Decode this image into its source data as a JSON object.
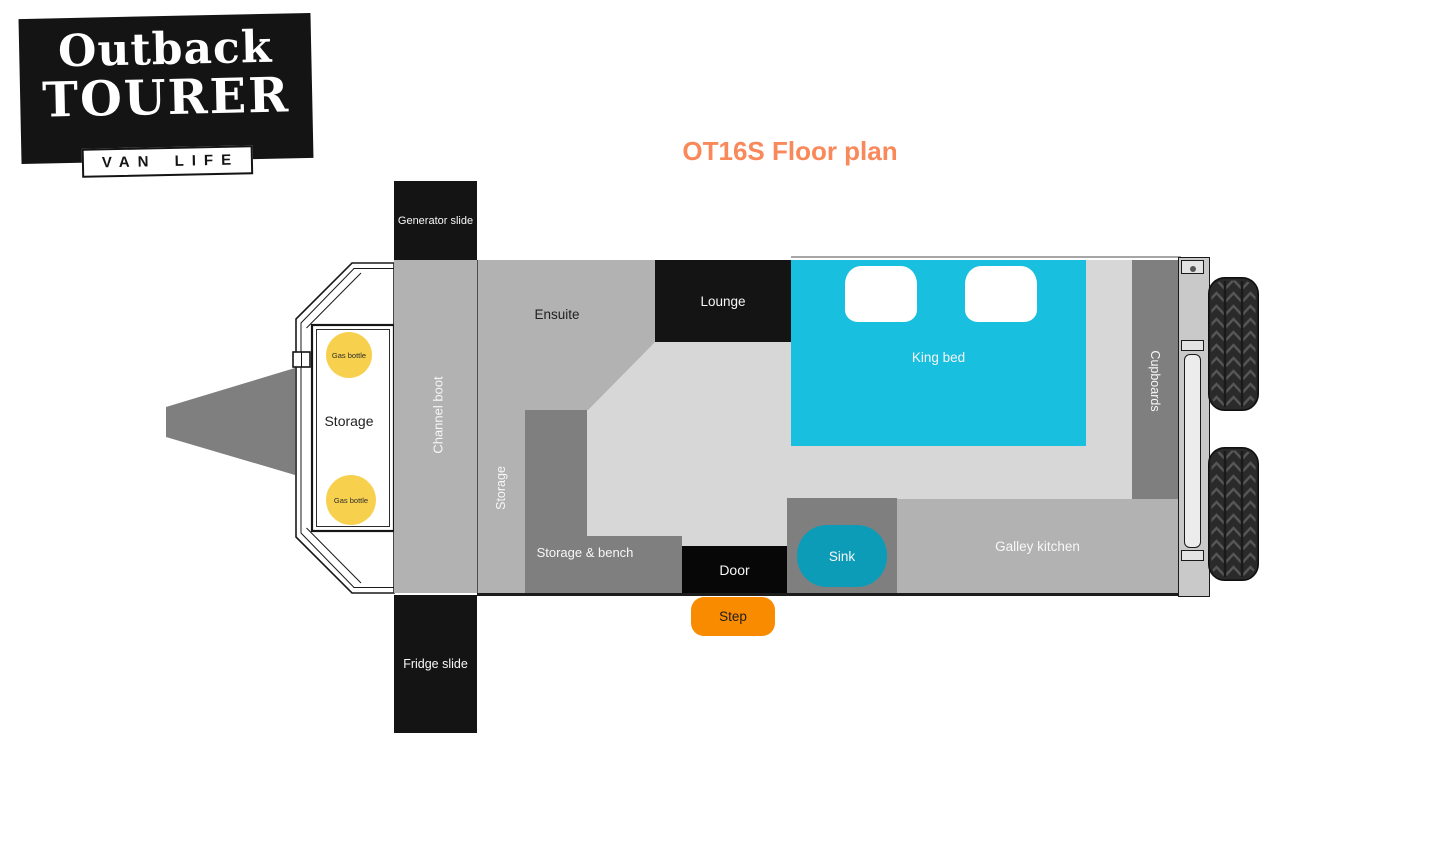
{
  "logo": {
    "line1": "Outback",
    "line2": "TOURER",
    "tagline": "VAN LIFE"
  },
  "title": "OT16S Floor plan",
  "rooms": {
    "generator_slide": "Generator slide",
    "fridge_slide": "Fridge slide",
    "channel_boot": "Channel boot",
    "side_storage": "Storage",
    "ensuite": "Ensuite",
    "lounge": "Lounge",
    "king_bed": "King bed",
    "cupboards": "Cupboards",
    "galley_kitchen": "Galley kitchen",
    "sink": "Sink",
    "door": "Door",
    "step": "Step",
    "storage_bench": "Storage & bench",
    "front_storage": "Storage",
    "gas_bottle_1": "Gas bottle",
    "gas_bottle_2": "Gas bottle"
  },
  "colors": {
    "ink": "#141414",
    "title_orange": "#f9885a",
    "bed_cyan": "#18bfdf",
    "sink_teal": "#0d9cb8",
    "step_orange": "#f98b00",
    "gas_yellow": "#f7d04e",
    "dark_gray": "#7f7f7f",
    "mid_gray": "#b2b2b2",
    "floor_gray": "#d7d7d7"
  }
}
